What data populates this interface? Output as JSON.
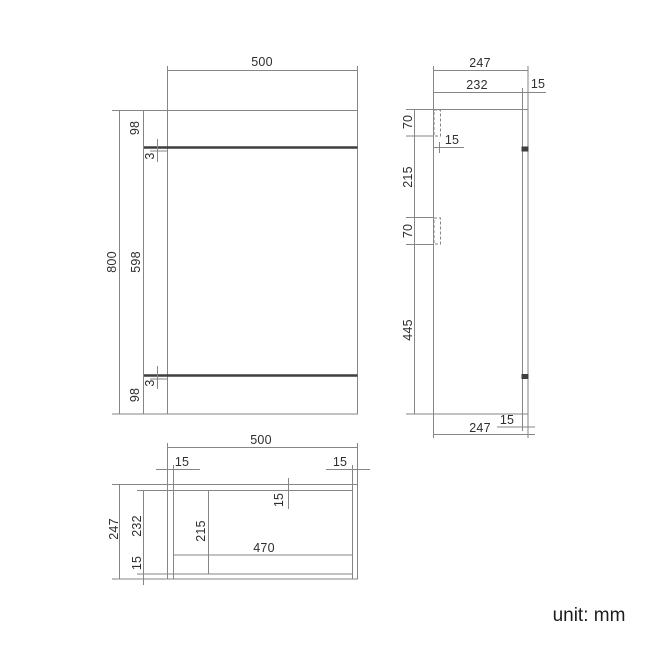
{
  "unit_label": "unit: mm",
  "front": {
    "overall_width": "500",
    "overall_height": "800",
    "top_panel": "98",
    "top_gap": "3",
    "door": "598",
    "bottom_gap": "3",
    "plinth": "98"
  },
  "side": {
    "overall_depth": "247",
    "front_depth": "232",
    "back_panel": "15",
    "top_bracket": "70",
    "bracket_depth": "15",
    "between_brackets": "215",
    "bottom_bracket": "70",
    "below_brackets": "445",
    "back_panel_bottom": "15",
    "overall_depth_bottom": "247"
  },
  "plan": {
    "overall_width": "500",
    "left_panel": "15",
    "right_panel": "15",
    "back_panel": "15",
    "internal_depth": "215",
    "internal_width": "470",
    "overall_depth": "247",
    "depth_minus_back": "232",
    "front_rail": "15"
  },
  "colors": {
    "background": "#ffffff",
    "line": "#868686",
    "dark_line": "#3f3f3f",
    "text": "#2e2e2e"
  }
}
